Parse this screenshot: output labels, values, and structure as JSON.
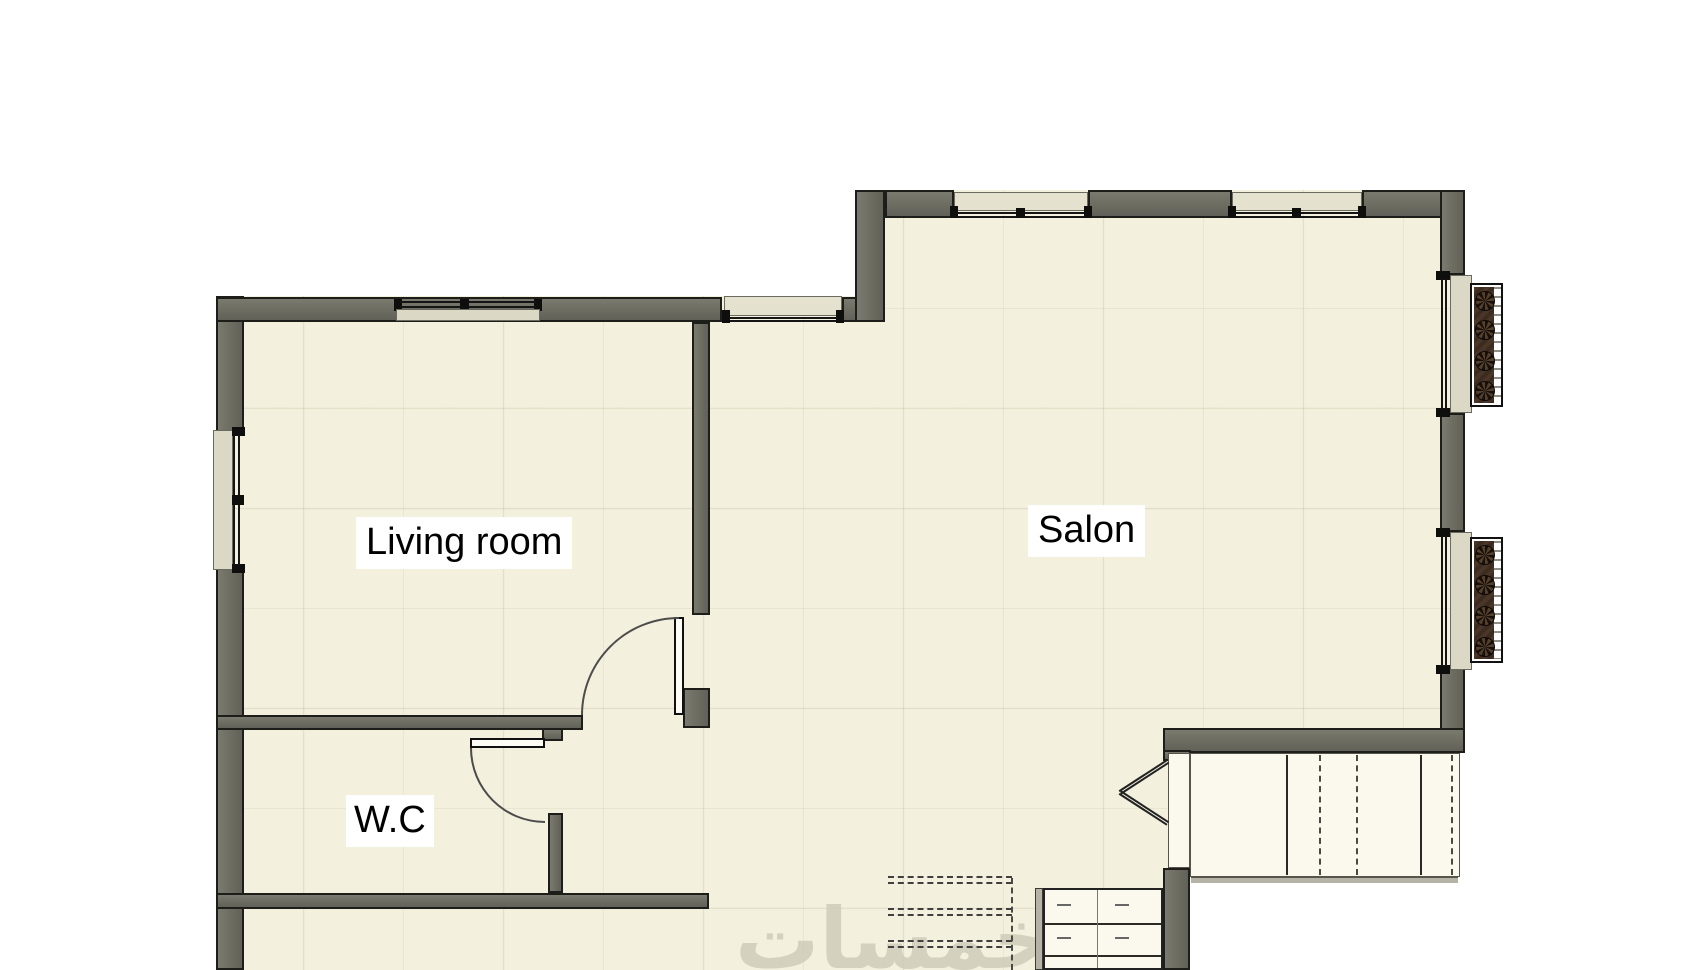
{
  "plan": {
    "type": "architectural-floor-plan",
    "rooms": {
      "living_room": {
        "label": "Living room"
      },
      "salon": {
        "label": "Salon"
      },
      "wc": {
        "label": "W.C"
      }
    },
    "watermark": {
      "text": "خمسات"
    },
    "features": {
      "windows": 7,
      "doors": 2,
      "radiators": 2,
      "staircases": 2,
      "direction_marker": "left-pointing double chevron at stair landing"
    },
    "colors": {
      "wall_fill": "#6c6c61",
      "wall_outline": "#1d1d1a",
      "floor": "#f3f0dd",
      "window_sill": "#dbd8c5",
      "radiator_brown": "#4a3628",
      "stair_fill": "#fbf9ee",
      "label_bg": "#ffffff",
      "label_text": "#000000",
      "watermark": "#cfccba"
    }
  }
}
